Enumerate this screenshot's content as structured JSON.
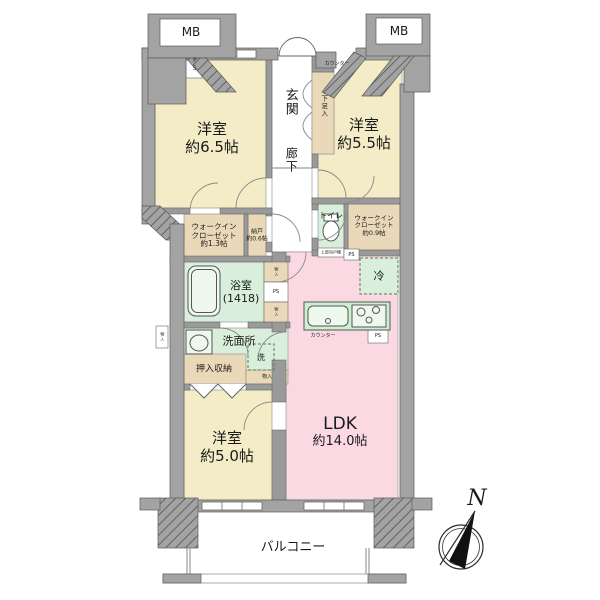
{
  "rooms": {
    "bedroom_65": {
      "name": "洋室",
      "area": "約6.5帖"
    },
    "bedroom_55": {
      "name": "洋室",
      "area": "約5.5帖"
    },
    "bedroom_50": {
      "name": "洋室",
      "area": "約5.0帖"
    },
    "ldk": {
      "name": "LDK",
      "area": "約14.0帖"
    },
    "entrance": {
      "name": "玄関"
    },
    "hallway": {
      "name": "廊下"
    },
    "wic_13": {
      "line1": "ウォークイン",
      "line2": "クローゼット",
      "line3": "約1.3帖"
    },
    "wic_09": {
      "line1": "ウォークイン",
      "line2": "クローゼット",
      "line3": "約0.9帖"
    },
    "storeroom": {
      "name": "納戸",
      "area": "約0.6帖"
    },
    "toilet": {
      "name": "トイレ"
    },
    "bathroom": {
      "name": "浴室",
      "size": "(1418)"
    },
    "washroom": {
      "name": "洗面所"
    },
    "oshiire": {
      "name": "押入収納"
    },
    "balcony": {
      "name": "バルコニー"
    }
  },
  "fixtures": {
    "mb": "MB",
    "ps": "PS",
    "shoe_cabinet": "下足入",
    "entrance_counter": "カウンター",
    "kitchen_counter": "カウンター",
    "refrigerator": "冷",
    "washing_machine": "洗",
    "closet_small": "物入",
    "toilet_shelf": "上部吊戸棚",
    "compass_north": "N"
  },
  "colors": {
    "room_yellow": "#f3ecc6",
    "ldk_pink": "#fad9e3",
    "wet_green": "#d9efdb",
    "closet_tan": "#ead9b8",
    "wall_gray": "#a3a3a3"
  }
}
